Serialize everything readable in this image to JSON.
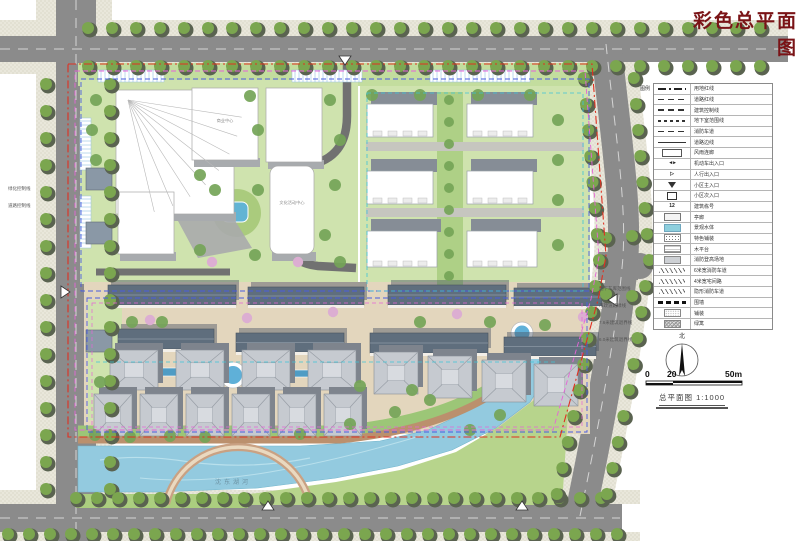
{
  "title": "彩色总平面图",
  "legend": {
    "heading": "图例",
    "rows": [
      {
        "symbol": "dashdot",
        "label": "用地红线"
      },
      {
        "symbol": "dash",
        "label": "道路红线"
      },
      {
        "symbol": "dash",
        "label": "建筑控制线"
      },
      {
        "symbol": "dashshort",
        "label": "地下室范围线"
      },
      {
        "symbol": "dash",
        "label": "消防车道"
      },
      {
        "symbol": "solid",
        "label": "道路边线"
      },
      {
        "symbol": "rect",
        "label": "风雨连廊"
      },
      {
        "symbol": "txtA",
        "label": "机动车出入口"
      },
      {
        "symbol": "txtB",
        "label": "人行出入口"
      },
      {
        "symbol": "tri",
        "label": "小区主入口"
      },
      {
        "symbol": "tri2",
        "label": "小区次入口"
      },
      {
        "symbol": "num",
        "label": "建筑栋号"
      },
      {
        "symbol": "box",
        "label": "亭廊"
      },
      {
        "symbol": "boxblue",
        "label": "景观水体"
      },
      {
        "symbol": "boxdots",
        "label": "特色铺装"
      },
      {
        "symbol": "boxlines",
        "label": "木平台"
      },
      {
        "symbol": "boxgray",
        "label": "消防登高场地"
      },
      {
        "symbol": "wave",
        "label": "6米宽消防车道"
      },
      {
        "symbol": "wave",
        "label": "4米宽宅间路"
      },
      {
        "symbol": "wave",
        "label": "隐形消防车道"
      },
      {
        "symbol": "dashbold",
        "label": "围墙"
      },
      {
        "symbol": "stipple",
        "label": "铺装"
      },
      {
        "symbol": "cross",
        "label": "绿篱"
      }
    ]
  },
  "annotations": {
    "right": [
      "地下车库范围线",
      "市政道路绿线",
      "7.6米建筑退界线",
      "6.0米建筑退界线"
    ],
    "left": [
      "绿化控制线",
      "道路控制线"
    ]
  },
  "plan": {
    "river_label": "沈东湖河",
    "center_label": "文化活动中心",
    "mall_label": "商业中心"
  },
  "compass": {
    "north_label": "北"
  },
  "scalebar": {
    "t0": "0",
    "t1": "20",
    "t2": "50m"
  },
  "caption": {
    "text": "总平面图",
    "ratio": "1:1000"
  },
  "colors": {
    "title_red": "#7a1316",
    "boundary_red": "#e03020",
    "boundary_magenta": "#e664d8",
    "boundary_blue": "#4a5ce0",
    "boundary_cyan": "#3ec3d8",
    "road_gray": "#8b8b8b",
    "water_blue": "#93cadf",
    "lawn_green": "#b7d48c",
    "block_green": "#cfe3ae",
    "street_paving": "#e3d6bd"
  }
}
